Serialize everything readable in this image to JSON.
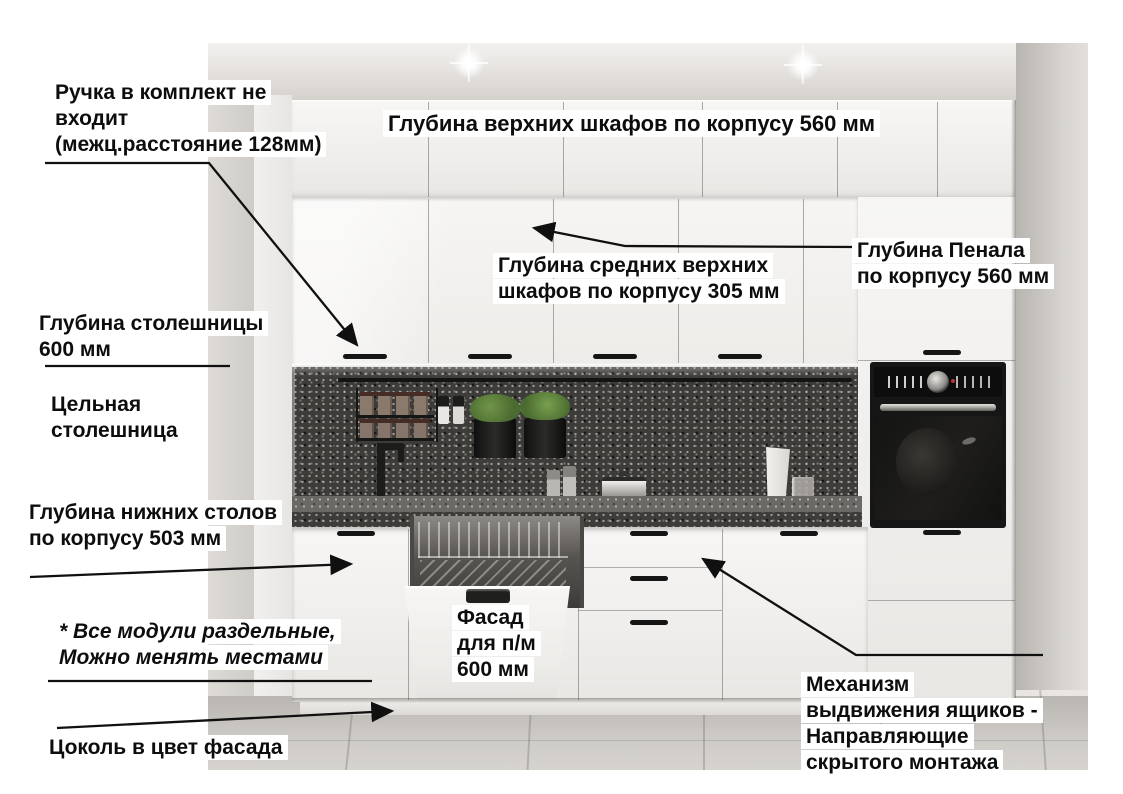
{
  "labels": {
    "handle_note": "Ручка в комплект не\nвходит\n(межц.расстояние 128мм)",
    "upper_depth": "Глубина верхних шкафов по корпусу 560 мм",
    "mid_upper_depth": "Глубина средних верхних\nшкафов по корпусу 305 мм",
    "tall_unit_depth": "Глубина Пенала\nпо корпусу 560 мм",
    "countertop_depth": "Глубина столешницы\n600 мм",
    "solid_countertop": "Цельная\nстолешница",
    "base_depth": "Глубина нижних столов\nпо корпусу 503 мм",
    "modules_note": "* Все модули раздельные,\nМожно менять местами",
    "plinth_note": "Цоколь в цвет фасада",
    "dishwasher_facade": "Фасад\nдля п/м\n600 мм",
    "drawer_mechanism": "Механизм\nвыдвижения ящиков -\nНаправляющие\nскрытого монтажа"
  },
  "colors": {
    "annotation_line": "#101010",
    "label_background": "#ffffff",
    "cabinet_white": "#f3f2ef",
    "backsplash_dark": "#3d3c39",
    "countertop_dark": "#44423f",
    "floor_gray": "#c6c3be"
  }
}
